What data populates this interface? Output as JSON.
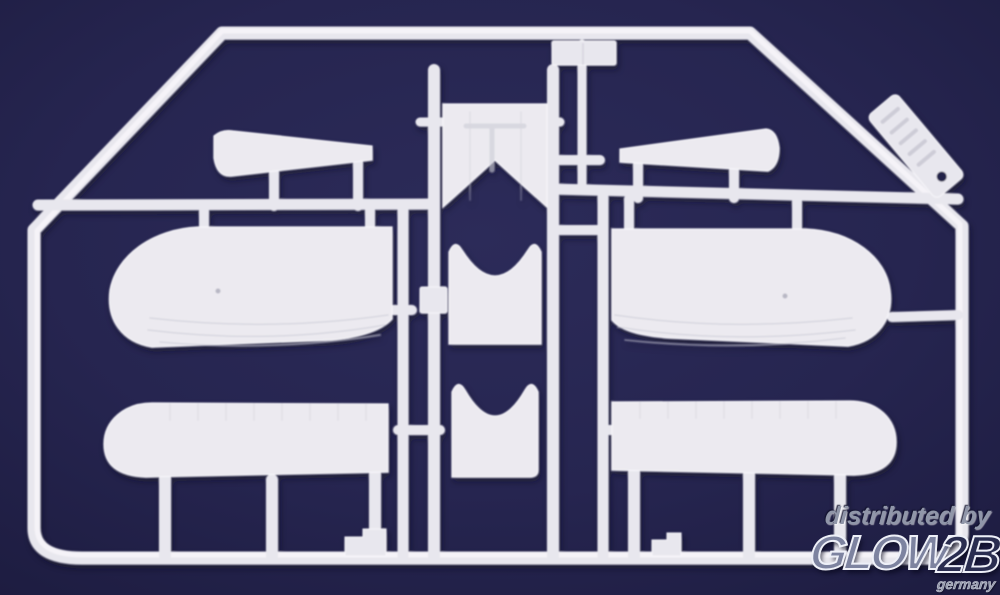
{
  "watermark": {
    "distributed_by": "distributed by",
    "brand_glow": "GLOW",
    "brand_2b": "2B",
    "country": "germany"
  },
  "colors": {
    "background-center": "#2c2b59",
    "background-mid": "#262550",
    "background-edge": "#1d1c40",
    "plastic": "#e8e7ee",
    "plastic-bright": "#f7f6fa",
    "plastic-shade": "#cfced9",
    "part-fill": "#eceaf0",
    "detail-line": "#c9c8d3",
    "tag-hole": "#23224a",
    "watermark-gray": "#9096a9",
    "brand-fill": "#7d83a0",
    "brand-2b-fill": "#2a2d50",
    "brand-outline": "#eef0f8"
  }
}
